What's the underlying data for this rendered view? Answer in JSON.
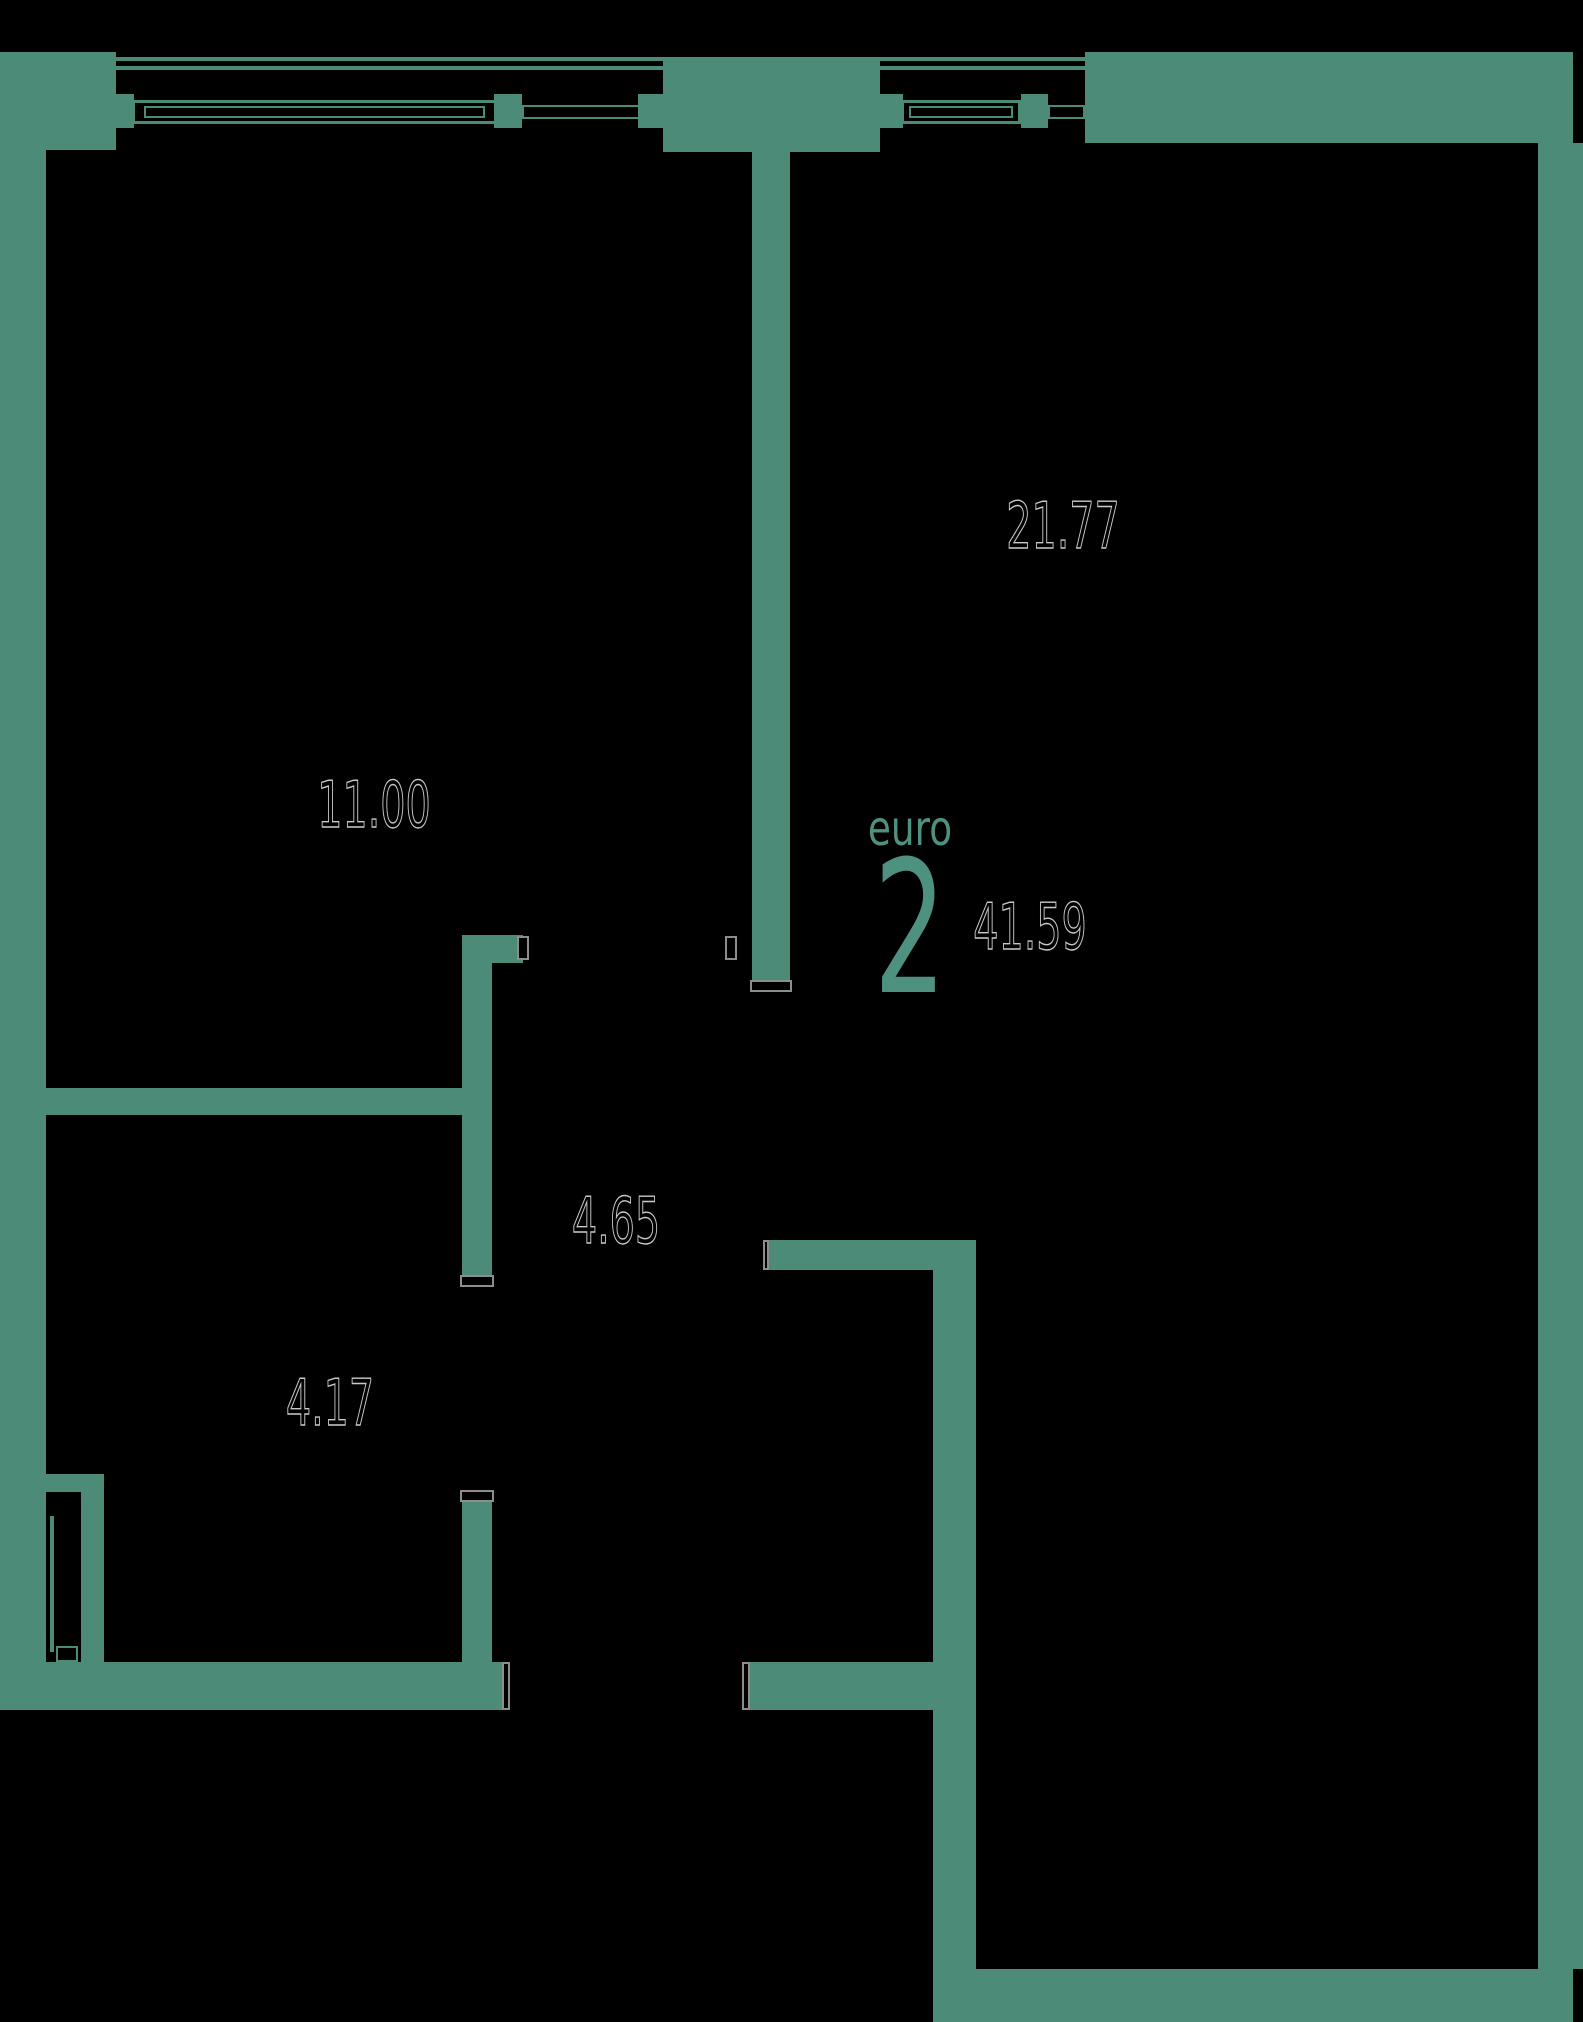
{
  "plan": {
    "unit_type_label": "euro",
    "unit_rooms_count": "2",
    "total_area": "41.59",
    "rooms": [
      {
        "id": "living-kitchen",
        "area": "21.77"
      },
      {
        "id": "bedroom",
        "area": "11.00"
      },
      {
        "id": "hallway",
        "area": "4.65"
      },
      {
        "id": "bathroom",
        "area": "4.17"
      }
    ],
    "colors": {
      "wall": "#4b8b78",
      "background": "#000000",
      "area_text_outline": "#c9c9c9",
      "accent_text": "#4f9181"
    }
  }
}
